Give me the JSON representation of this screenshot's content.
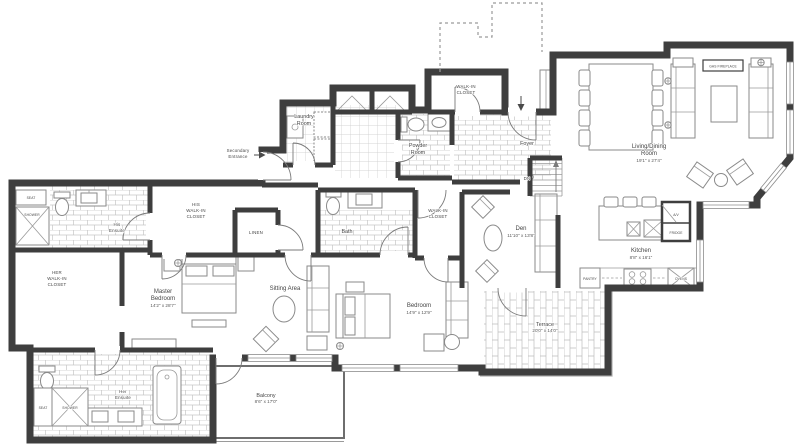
{
  "colors": {
    "wall": "#3e3e3e",
    "furniture_line": "#8a8a8a",
    "tile_line": "#c6c6c6",
    "label_text": "#454545",
    "background": "#ffffff"
  },
  "labels": {
    "seat_top": [
      "SEAT"
    ],
    "shower_top": [
      "SHOWER"
    ],
    "his_ensuite": [
      "His",
      "Ensuite"
    ],
    "his_wic": [
      "HIS",
      "WALK-IN",
      "CLOSET"
    ],
    "her_wic": [
      "HER",
      "WALK-IN",
      "CLOSET"
    ],
    "linen": [
      "LINEN"
    ],
    "master": [
      "Master",
      "Bedroom",
      "14'2\" x 28'7\""
    ],
    "sitting": [
      "Sitting Area"
    ],
    "her_ensuite": [
      "Her",
      "Ensuite"
    ],
    "seat_bottom": [
      "SEAT"
    ],
    "shower_bottom": [
      "SHOWER"
    ],
    "balcony": [
      "Balcony",
      "8'6\" x 17'0\""
    ],
    "secondary_entrance": [
      "Secondary",
      "Entrance"
    ],
    "laundry": [
      "Laundry",
      "Room"
    ],
    "powder": [
      "Powder",
      "Room"
    ],
    "entry_wic": [
      "WALK-IN",
      "CLOSET"
    ],
    "foyer": [
      "Foyer"
    ],
    "bath": [
      "Bath"
    ],
    "bedroom_wic": [
      "WALK-IN",
      "CLOSET"
    ],
    "den": [
      "Den",
      "11'10\" x 13'8\""
    ],
    "bedroom": [
      "Bedroom",
      "14'9\" x 12'9\""
    ],
    "terrace": [
      "Terrace",
      "20'0\" x 14'0\""
    ],
    "living_dining": [
      "Living/Dining",
      "Room",
      "19'1\" x 27'4\""
    ],
    "kitchen": [
      "Kitchen",
      "8'8\" x 16'1\""
    ],
    "gas_fireplace": [
      "GAS FIREPLACE"
    ],
    "av": [
      "A/V"
    ],
    "fridge": [
      "FRIDGE"
    ],
    "pantry": [
      "PANTRY"
    ],
    "ovens": [
      "OVENS"
    ],
    "dn": [
      "DN"
    ]
  }
}
